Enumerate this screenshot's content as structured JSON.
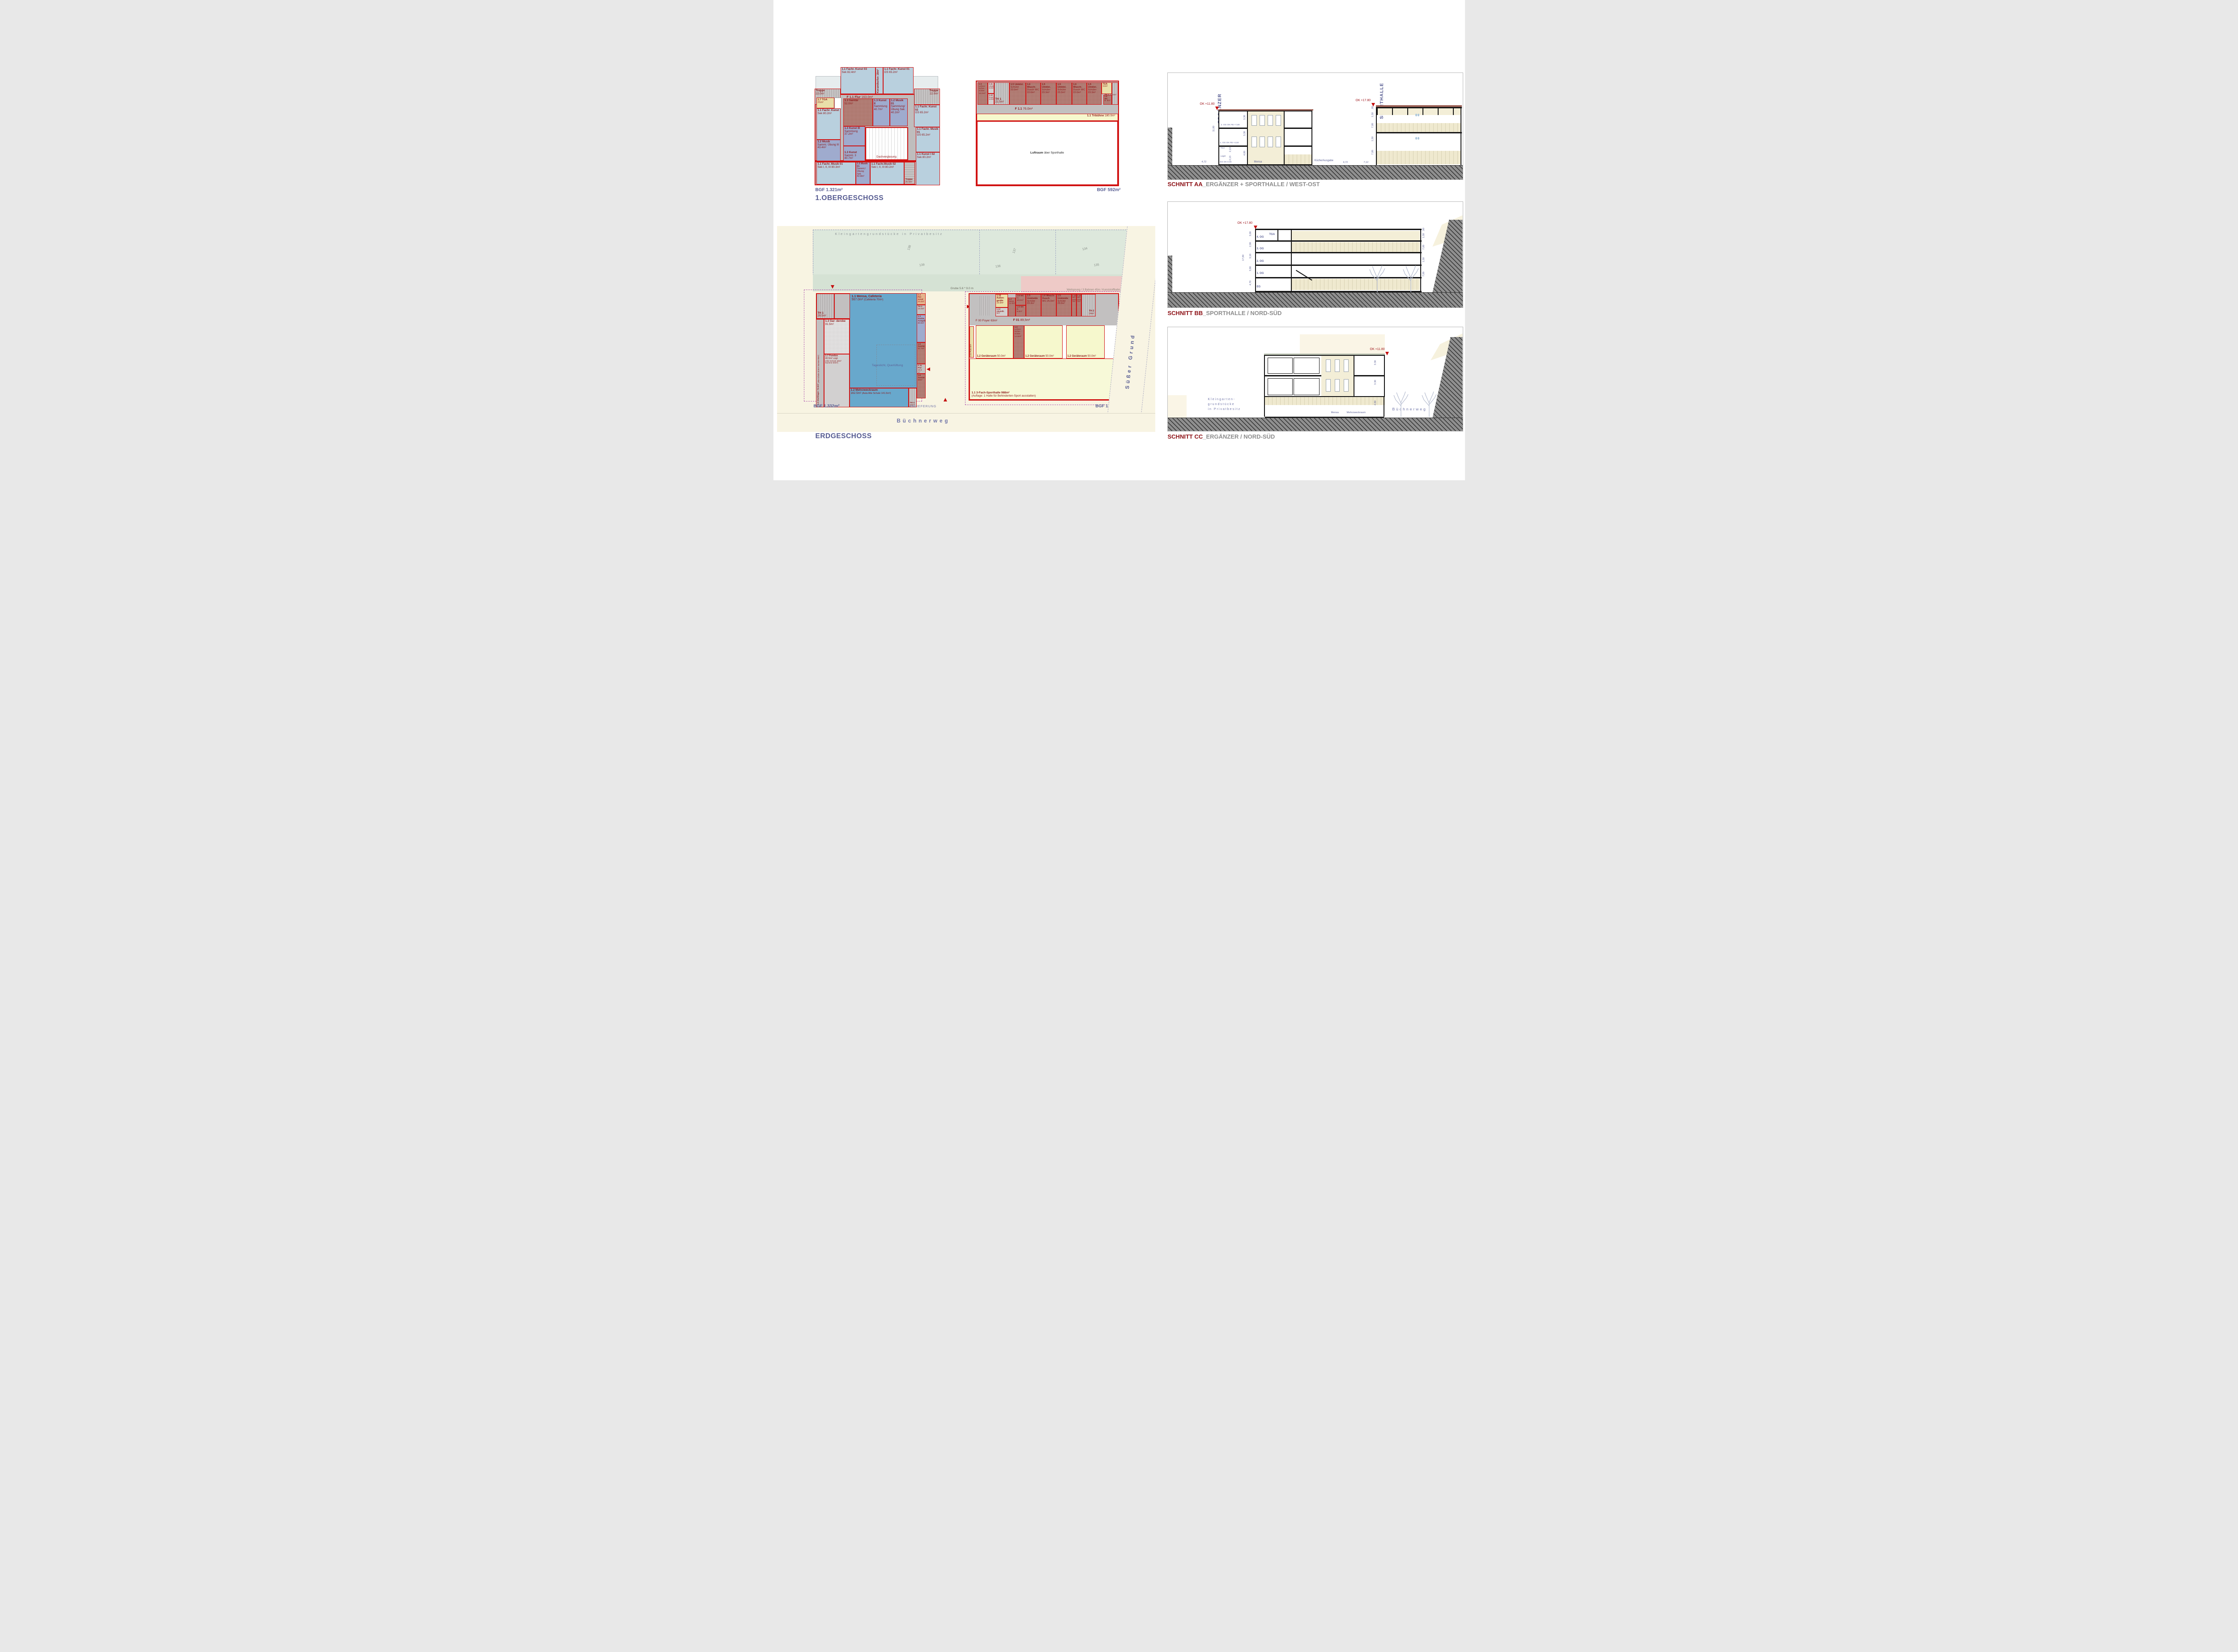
{
  "colors": {
    "wall_red": "#d11212",
    "label_red": "#8d1717",
    "navy": "#565b91",
    "title_red": "#8c1015",
    "title_gray": "#8d8d8d",
    "room_blue": "#b9d0de",
    "room_purple": "#9fabce",
    "room_darkred": "#a76c63",
    "room_khaki": "#e9dfa9",
    "mensa_blue": "#68a8cc",
    "hall_yellow": "#f6f8cd",
    "site_green": "#dde8dc",
    "track_pink": "#eecac7"
  },
  "og": {
    "title": "1.OBERGESCHOSS",
    "bgf": "BGF 1.321m²",
    "rooms": {
      "terrl": "Terrasse",
      "terrr": "Terrasse",
      "kunst03": {
        "n": "1.1 Fachr. Kunst 03",
        "a": "Sek 82.4m²"
      },
      "keramik": "Keramikofen 18m²",
      "kunst01": {
        "n": "1.1 Fachr. Kunst 01",
        "a": "GS 65.2m²"
      },
      "treppetl": {
        "n": "Treppe",
        "a": "22.0m²"
      },
      "treppetr": {
        "n": "Treppe",
        "a": "22.0m²"
      },
      "flur": {
        "n": "F 1.1 Flur",
        "a": "163.0m²"
      },
      "tga": {
        "n": "1.7 TGA",
        "a": "21m²"
      },
      "kunstsek": {
        "n": "1.1 Fachr. Kunst",
        "a": "Sek 80.2m²"
      },
      "musik3": {
        "n": "1.2 Musik",
        "a": "Samml. Übung III 43.4m²"
      },
      "sanitaer": {
        "n": "1.3 Sanitär",
        "a": "52.0m²"
      },
      "kunst2": {
        "n": "1.3 Kunst II",
        "a": "Sammlung 40.7m²"
      },
      "musik01s": {
        "n": "1.2 Musik 01",
        "a": "Sammlung/ Übung Sek 40.2m²"
      },
      "kunst3": {
        "n": "1.3 Kunst III",
        "a": "Sammlung 37.2m²"
      },
      "kunsts3": {
        "n": "1.3 Kunst",
        "a": "Samml. 3 40.7m²"
      },
      "dach": "Dachverglasung",
      "kunst02": {
        "n": "1.1 Fachr. Kunst 02",
        "a": "GS 65.2m²"
      },
      "fmusik01gs": {
        "n": "1.1 Fachr. Musik 01",
        "a": "GS 65.2m²"
      },
      "kunsti02": {
        "n": "1.1 Kunst I 02",
        "a": "Sek 80.2m²"
      },
      "fmusik01": {
        "n": "1.1 Fachr. Musik 01",
        "a": "Sek I, II, III 80.3m²"
      },
      "musik01u": {
        "n": "1.2 Musik 01",
        "a": "Samml./Übung Sek 42.8m²"
      },
      "fmusik02": {
        "n": "1.1 Fachr.Musik 02",
        "a": "Sek I, II, III 80.2m²"
      },
      "treppeb": {
        "n": "Treppe",
        "a": "20.0m²"
      }
    }
  },
  "oghall": {
    "bgf": "BGF 592m²",
    "rooms": {
      "lehrer": {
        "n": "1.4",
        "a": "Lehrer- Schie.- richter 15.0m²"
      },
      "abstell": {
        "n": "1.11",
        "a": "Abstell. 6.0m²"
      },
      "pumi": {
        "n": "1.12",
        "a": "Pumi 6.0m²"
      },
      "th1a": {
        "n": "TH 1",
        "a": "21.5m²"
      },
      "umk1": {
        "n": "1.5 Umklei.",
        "a": "Schüler 22.0m²"
      },
      "wasch1": {
        "n": "1.6 Wasch-",
        "a": "Dusch WC 22.0m²"
      },
      "umk2": {
        "n": "1.5 Umklei.",
        "a": "Schüler 23.3m²"
      },
      "umk3": {
        "n": "1.5 Umklei.",
        "a": "Schüler 23.3m²"
      },
      "wasch2": {
        "n": "1.6 Wasch-",
        "a": "Dusch WC 22.0m²"
      },
      "umk4": {
        "n": "1.5 Umklei.",
        "a": "Schüler 23.3m²"
      },
      "tga": {
        "n": "TGA",
        "a": "11m²"
      },
      "wc": {
        "n": "1.9 WC",
        "a": "B. 6m²"
      },
      "th1b": {
        "n": "TH 1",
        "a": "17.0m²"
      },
      "flur": {
        "n": "F 1.1",
        "a": "76.0m²"
      },
      "tribuene": {
        "n": "1.1 Tribühne",
        "a": "180.0m²"
      },
      "luftraum": {
        "n": "Luftraum",
        "a": "über Sporthalle"
      }
    }
  },
  "eg": {
    "title": "ERDGESCHOSS",
    "bgf_left": "BGF 1.332m²",
    "bgf_right": "BGF 1.582m²",
    "garden": "Kleingartengrundstücke in Privatbesitz",
    "plots": [
      "138",
      "137",
      "134",
      "139",
      "136",
      "135"
    ],
    "track": "Weitsprung / 3 Bahnen 45m / Kunststoffbahn",
    "grube": "Grube 5.6 * 9.0 m",
    "street_right": "Süßer Grund",
    "street_bottom": "Büchnerweg",
    "anlieferung": "ANLIEFERUNG",
    "left": {
      "th1": {
        "n": "TH 1",
        "a": "29.5m²"
      },
      "mensa": {
        "n": "1.1 Mensa, Cafeteria",
        "a": "567.0m²",
        "a2": "(Cafeteria 70m²)"
      },
      "personal": {
        "n": "1.4 Per- sonal",
        "a": "10.4m²"
      },
      "th2": {
        "n": "TH 2",
        "a": "18.0m²"
      },
      "kueche": {
        "n": "1.3 Küche, Ausgabe",
        "a": "80.8m²"
      },
      "san527": {
        "n": "1.6 Sanitär",
        "a": "52.7m²"
      },
      "f01": {
        "n": "F 01 Flur",
        "a": "18.0 m²"
      },
      "san60": {
        "n": "1.6 Sanitär",
        "a": "60m²"
      },
      "garderobe": {
        "n": "1.3 Gar- derobe",
        "a": "91.5m²"
      },
      "stuhllager": {
        "n": "1.8 Stuhllager 72.6m²",
        "a": "(Alte Schule 30.5m² Summe 90m²)"
      },
      "fundus": {
        "n": "1.7 Fundus",
        "a": "40.5m² zzgl.",
        "a2": "(Alte Schule 20m² Summe 60m²)"
      },
      "mehrzweck": {
        "n": "1.2 Mehrzweckraum",
        "a": "162.5m²",
        "a2": "(Aula Alte Schule 141.5m²)"
      },
      "th3": {
        "n": "TH 3",
        "a": "22m²"
      },
      "tageslicht": "Tageslicht, Querlüftung"
    },
    "hall": {
      "aussen": {
        "n": "1.10 Außen- geräte",
        "a": "15.0m²"
      },
      "abstellr": {
        "n": "1.12 Abstellr.",
        "a": "9m²"
      },
      "wcd": {
        "n": "1.7",
        "a": "WCD. 12.0m²"
      },
      "wch": {
        "n": "1.8 WC",
        "a": "H. 10.0m²"
      },
      "wcb": {
        "n": "1.9 WC",
        "a": "B. 6.0m²"
      },
      "umk1": {
        "n": "1.5 Umkleide",
        "a": "Schüler 23.3m²"
      },
      "wasch": {
        "n": "1.6 Wasch- Dusch",
        "a": "WC 25.0m²"
      },
      "umk2": {
        "n": "1.5 Umkleide",
        "a": "Schüler 23.0m²"
      },
      "zusa1": {
        "n": "1.12",
        "a": "WC- Zusa 7m²"
      },
      "zusa2": {
        "n": "1.12",
        "a": "WC- Zusa 7m²"
      },
      "th2": {
        "n": "TH 2",
        "a": "14m²"
      },
      "foyer": "F 00 Foyer 63m²",
      "f01": {
        "n": "F 01",
        "a": "89,5m²"
      },
      "pumi": "1.11 Pumi 5m²",
      "ger1": {
        "n": "1.2 Geräteraum",
        "a": "50.0m²"
      },
      "lehrer": {
        "n": "1.4",
        "a": "Lehrer- Schie.- richter 14.8m²"
      },
      "ger2": {
        "n": "1.2 Geräteraum",
        "a": "50.0m²"
      },
      "ger3": {
        "n": "1.2 Geräteraum",
        "a": "50.0m²"
      },
      "halle": {
        "n": "1.1 3-Fach-Sporthalle 988m²",
        "a": "(Auflage: 1 Halle für Behinderten-Sport ausstatten)"
      }
    }
  },
  "sections": {
    "aa": {
      "t1": "SCHNITT AA",
      "t2": "_ERGÄNZER + SPORTHALLE / WEST-OST",
      "kita": "KITA",
      "ergaenzer": "ERGÄNZER",
      "sporthalle": "SPORTHALLE",
      "ok1": "OK +11.80",
      "ok2": "OK +17.80",
      "og2": "2. OG OK FB +7,80",
      "og1": "1. OG OK FB +4,50",
      "eg0": "EG OK 0.00",
      "tga": "TGA",
      "lager": "Lager",
      "mensa": "Mensa",
      "kueche": "Küche/Ausgabe",
      "d330a": "3,30",
      "d330b": "3,30",
      "d480": "4,80",
      "d1180": "11,80",
      "d472": "4,72",
      "d213a": "2,13",
      "d213b": "2,13",
      "d472b": "4,72",
      "d712": "7,12",
      "d80": ",80",
      "d150a": "1,50",
      "d700a": "7,00",
      "d150b": "1,50",
      "d700b": "7,00"
    },
    "bb": {
      "t1": "SCHNITT BB",
      "t2": "_SPORTHALLE / NORD-SÜD",
      "ok": "OK +17.80",
      "tga": "TGA",
      "f4": "4. OG",
      "f3": "3. OG",
      "f2": "2. OG",
      "f1": "1. OG",
      "f0": "EG",
      "dl": [
        "3,00",
        "2,90",
        "3,10",
        "3,80",
        "4,70"
      ],
      "total": "17,80",
      "dr": [
        ",80",
        "1,50",
        "7,00",
        "1,50",
        "7,00"
      ]
    },
    "cc": {
      "t1": "SCHNITT CC",
      "t2": "_ERGÄNZER / NORD-SÜD",
      "ok": "OK +11.80",
      "d1": "3.30",
      "d2": "3.30",
      "d3": "4.80",
      "kg1": "Kleingarten-",
      "kg2": "grundstücke",
      "kg3": "in Privatbesitz",
      "mensa": "Mensa",
      "mehrzweck": "Mehrzweckraum",
      "street": "Büchnerweg"
    }
  }
}
